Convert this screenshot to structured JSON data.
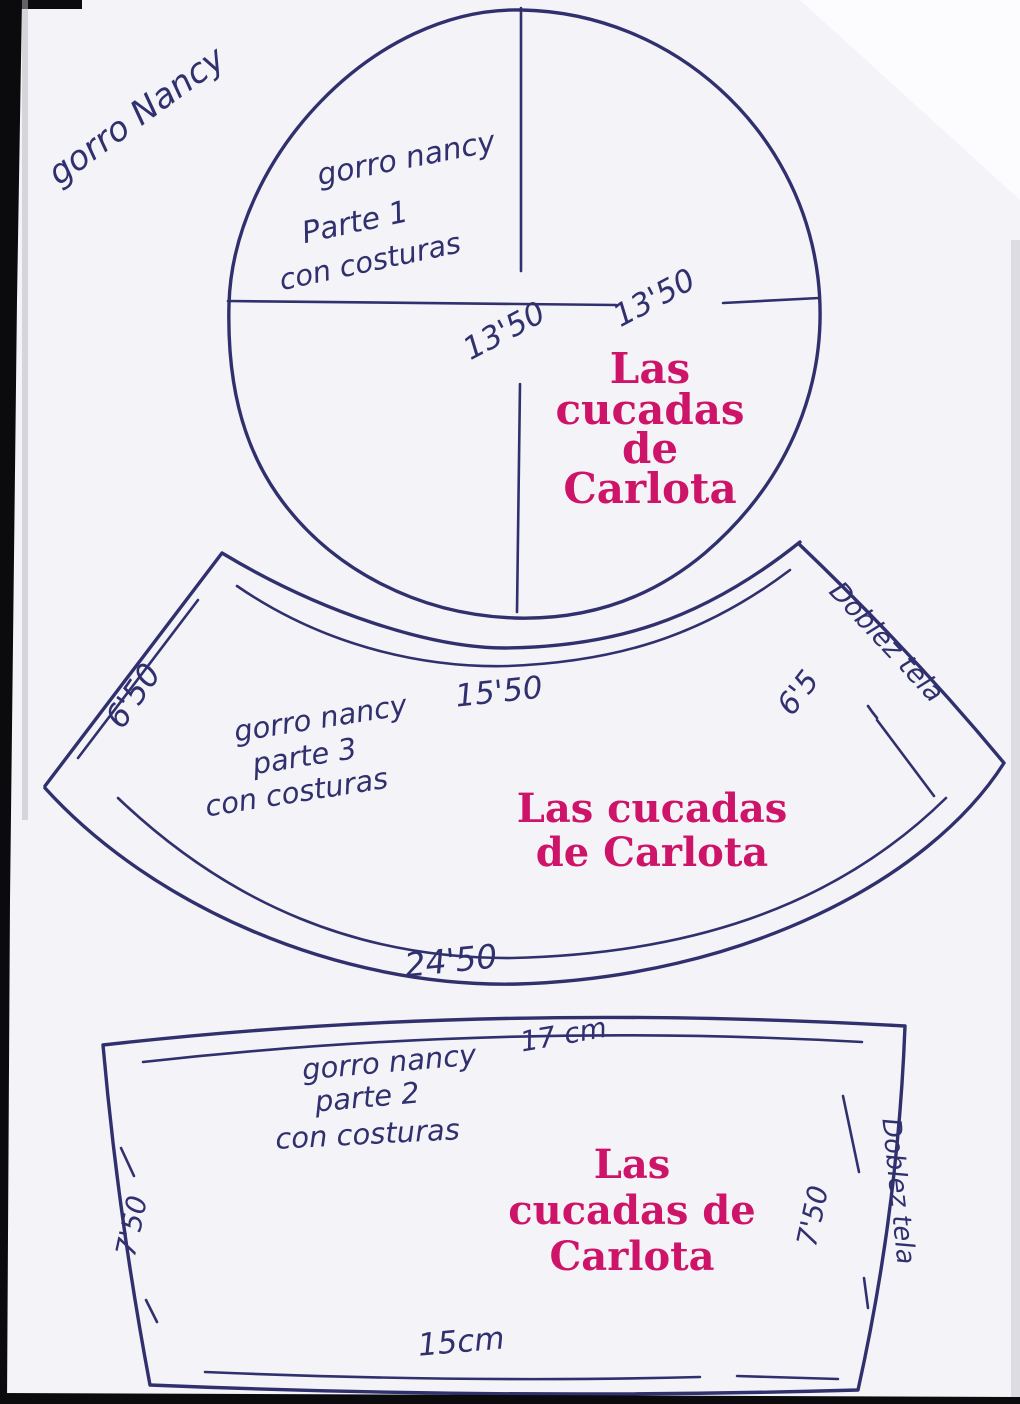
{
  "document": {
    "type": "scanned hand-drawn sewing pattern",
    "corner_note": "gorro Nancy",
    "colors": {
      "paper": "#f4f3f7",
      "ink": "#30306e",
      "brand_pink": "#cd1468",
      "scan_edge": "#0b0b0d"
    }
  },
  "piece1": {
    "shape": "circle",
    "name_line1": "gorro nancy",
    "name_line2": "Parte 1",
    "name_line3": "con costuras",
    "dim_left": "13'50",
    "dim_right": "13'50",
    "brand_line1": "Las",
    "brand_line2": "cucadas",
    "brand_line3": "de",
    "brand_line4": "Carlota"
  },
  "piece3": {
    "shape": "curved band",
    "name_line1": "gorro nancy",
    "name_line2": "parte 3",
    "name_line3": "con costuras",
    "dim_left": "6'50",
    "dim_top": "15'50",
    "dim_right": "6'5",
    "dim_bottom": "24'50",
    "fold_note": "Doblez tela",
    "brand_line1": "Las cucadas",
    "brand_line2": "de Carlota"
  },
  "piece2": {
    "shape": "trapezoid",
    "name_line1": "gorro nancy",
    "name_line2": "parte 2",
    "name_line3": "con costuras",
    "dim_top": "17 cm",
    "dim_left": "7'50",
    "dim_right": "7'50",
    "dim_bottom": "15cm",
    "fold_note": "Doblez tela",
    "brand_line1": "Las",
    "brand_line2": "cucadas de",
    "brand_line3": "Carlota"
  }
}
